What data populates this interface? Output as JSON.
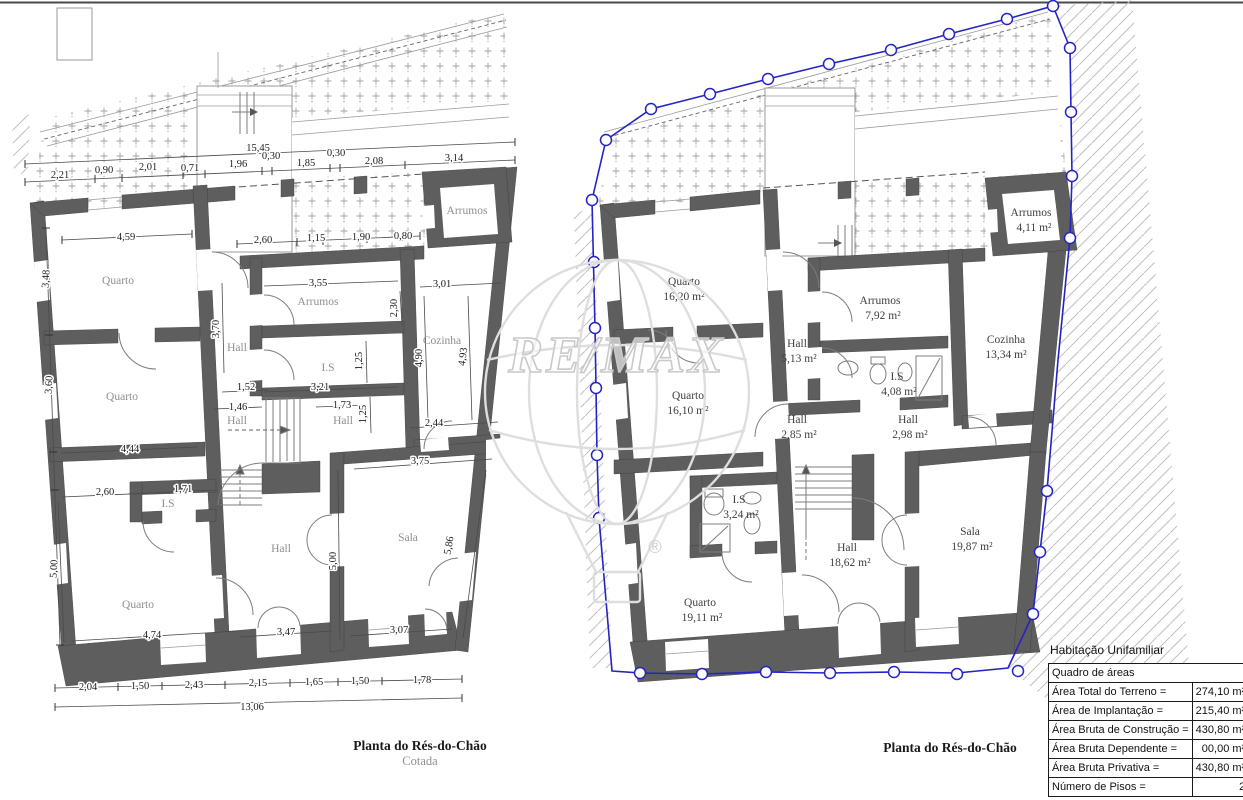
{
  "titles": {
    "left": "Planta do Rés-do-Chão",
    "left_sub": "Cotada",
    "right": "Planta do Rés-do-Chão"
  },
  "watermark": {
    "brand": "RE/MAX",
    "registered": "®"
  },
  "colors": {
    "wall": "#5e5e5e",
    "boundary_blue": "#2424c4",
    "hatch": "#a2a2a2"
  },
  "left_plan": {
    "rooms": [
      "Quarto",
      "Quarto",
      "Quarto",
      "Arrumos",
      "Arrumos",
      "Hall",
      "I.S",
      "Cozinha",
      "Hall",
      "Hall",
      "I.S",
      "Hall",
      "Sala"
    ],
    "dims": [
      "15,45",
      "2,21",
      "0,90",
      "2,01",
      "0,71",
      "1,96",
      "0,30",
      "1,85",
      "0,30",
      "2,08",
      "3,14",
      "4,59",
      "2,60",
      "1,15",
      "1,90",
      "0,80",
      "3,48",
      "3,60",
      "5,00",
      "3,55",
      "2,30",
      "3,01",
      "4,90",
      "4,93",
      "3,70",
      "1,52",
      "1,46",
      "3,21",
      "1,25",
      "1,73",
      "1,25",
      "2,44",
      "4,44",
      "2,60",
      "1,71",
      "5,00",
      "4,74",
      "3,47",
      "3,07",
      "3,75",
      "5,86",
      "2,04",
      "1,50",
      "2,43",
      "2,15",
      "1,65",
      "1,50",
      "1,78",
      "13,06"
    ]
  },
  "right_plan": {
    "rooms": [
      {
        "name": "Quarto",
        "area": "16,20 m²"
      },
      {
        "name": "Quarto",
        "area": "16,10 m²"
      },
      {
        "name": "Arrumos",
        "area": "7,92 m²"
      },
      {
        "name": "Cozinha",
        "area": "13,34 m²"
      },
      {
        "name": "I.S",
        "area": "4,08 m²"
      },
      {
        "name": "Hall",
        "area": "5,13 m²"
      },
      {
        "name": "Hall",
        "area": "2,85 m²"
      },
      {
        "name": "Hall",
        "area": "2,98 m²"
      },
      {
        "name": "Arrumos",
        "area": "4,11 m²"
      },
      {
        "name": "I.S",
        "area": "3,24 m²"
      },
      {
        "name": "Quarto",
        "area": "19,11 m²"
      },
      {
        "name": "Hall",
        "area": "18,62 m²"
      },
      {
        "name": "Sala",
        "area": "19,87 m²"
      }
    ]
  },
  "areas_table": {
    "title_above": "Habitação Unifamiliar",
    "header": "Quadro de áreas",
    "rows": [
      {
        "label": "Área Total do Terreno =",
        "value": "274,10 m²"
      },
      {
        "label": "Área de Implantação =",
        "value": "215,40 m²"
      },
      {
        "label": "Área Bruta de Construção =",
        "value": "430,80 m²"
      },
      {
        "label": "Área Bruta Dependente =",
        "value": "00,00 m²"
      },
      {
        "label": "Área Bruta Privativa =",
        "value": "430,80 m²"
      },
      {
        "label": "Número de Pisos =",
        "value": "2"
      }
    ]
  }
}
